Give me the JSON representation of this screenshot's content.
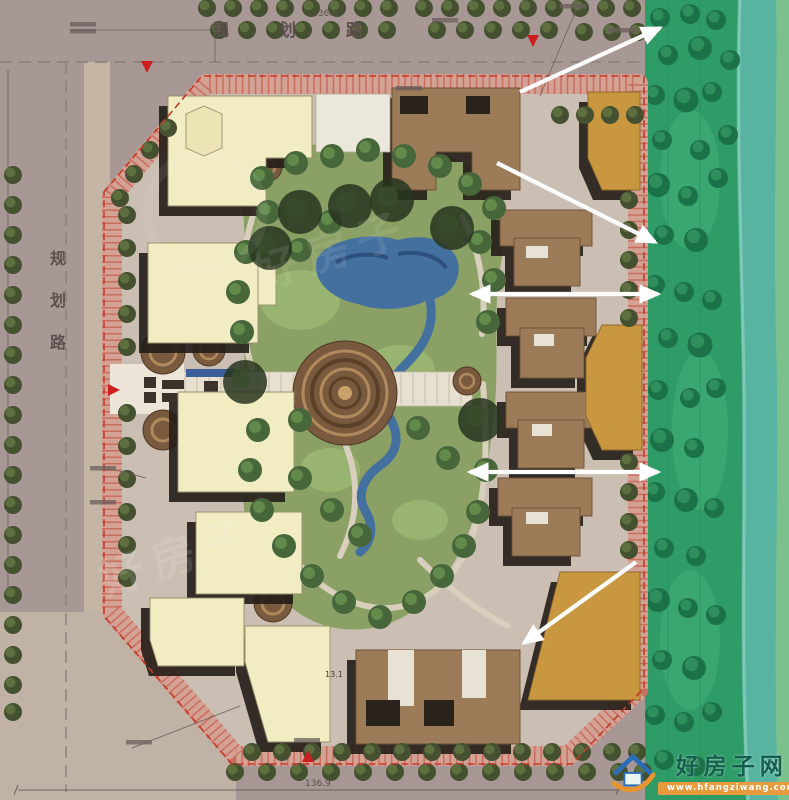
{
  "roads": {
    "top_label": "规 划 路",
    "top_dimension": "136.6",
    "left_label": "规划路",
    "bottom_dimension": "136.9",
    "inner_dimension": "13.1"
  },
  "watermark": {
    "site_name": "好房子网",
    "site_url": "www.hfangziwang.com"
  },
  "faint_watermark": {
    "text": "好房子"
  },
  "colors": {
    "road": "#a79896",
    "site_paving": "#cbbeb2",
    "ring_band": "#d4a295",
    "boundary_red": "#c23b2a",
    "building_cream": "#f2ecc2",
    "building_brown": "#9c7c58",
    "building_orange": "#c9973f",
    "greenbelt_green": "#2f9c68",
    "river_teal": "#58b4a1",
    "garden_green": "#8ba064",
    "water_blue": "#44709f",
    "view_arrow": "#ffffff",
    "entry_marker": "#cc2020"
  }
}
